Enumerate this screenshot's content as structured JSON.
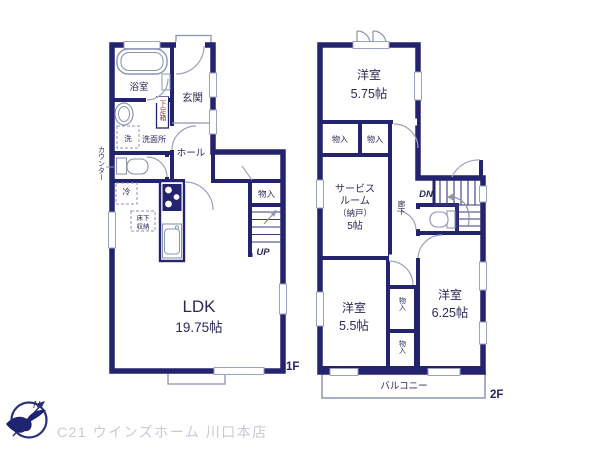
{
  "floor1": {
    "label": "1F",
    "bathroom": "浴室",
    "laundry": "洗",
    "washroom": "洗面所",
    "counter": "カウンター",
    "entrance": "玄関",
    "shoe_cabinet": "下足箱",
    "hall": "ホール",
    "fridge": "冷",
    "floor_storage_line1": "床下",
    "floor_storage_line2": "収納",
    "closet": "物入",
    "stairs_up": "UP",
    "ldk_name": "LDK",
    "ldk_size": "19.75帖"
  },
  "floor2": {
    "label": "2F",
    "bedroom_top": "洋室",
    "bedroom_top_size": "5.75帖",
    "closet_top_left": "物入",
    "closet_top_right": "物入",
    "service_line1": "サービス",
    "service_line2": "ルーム",
    "service_line3": "（納戸）",
    "service_line4": "5帖",
    "corridor": "廊下",
    "stairs_down": "DN",
    "bedroom_left": "洋室",
    "bedroom_left_size": "5.5帖",
    "bedroom_right": "洋室",
    "bedroom_right_size": "6.25帖",
    "closet_mid": "物入",
    "closet_bottom": "物入",
    "balcony": "バルコニー"
  },
  "footer": {
    "north": "N",
    "company": "C21 ウインズホーム 川口本店"
  },
  "colors": {
    "wall": "#23236E",
    "room_cream": "#FAF0CD",
    "room_pink": "#F9DDE3",
    "room_blue": "#DFEAF6",
    "shoe_label_red": "#9A3A3A",
    "logo_text_gray": "#C7C9DC"
  }
}
